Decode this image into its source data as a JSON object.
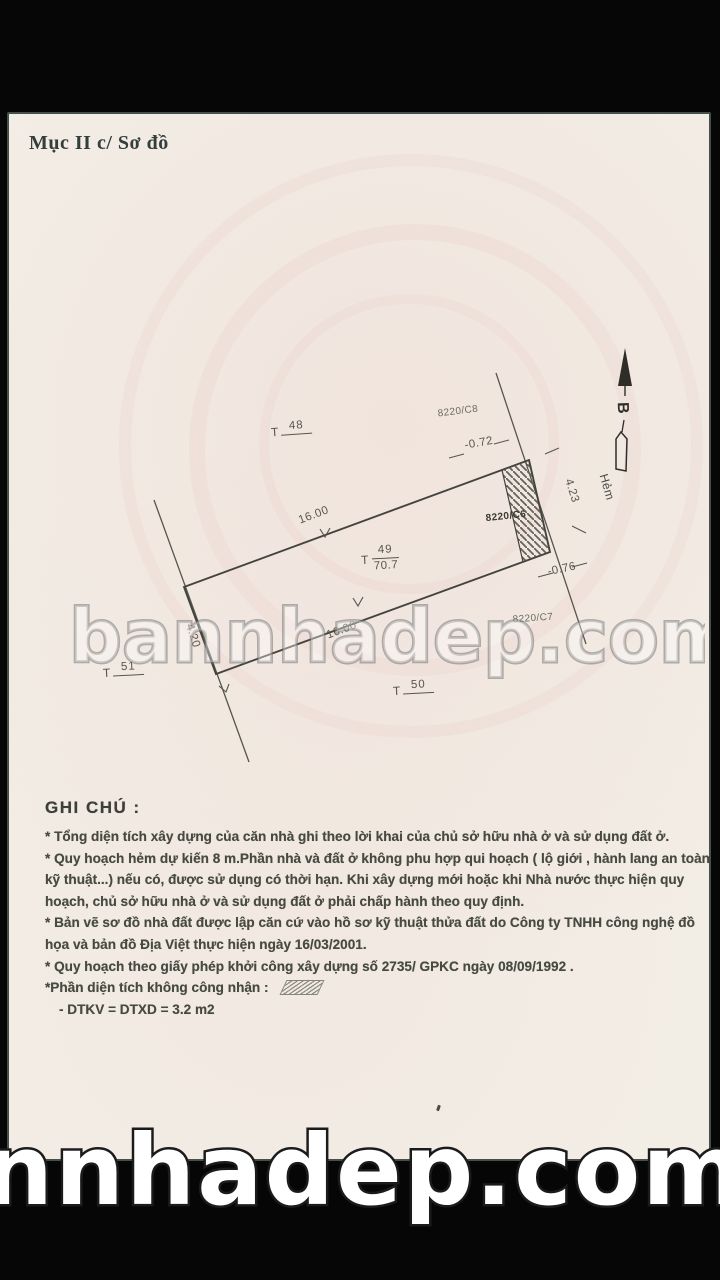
{
  "page": {
    "section_title": "Mục II c/ Sơ đồ"
  },
  "diagram": {
    "north_letter": "B",
    "alley_label": "Hẻm",
    "dim_top_edge": "16.00",
    "dim_bottom_edge": "16.00",
    "dim_left_edge": "4.20",
    "dim_right_edge": "4.23",
    "dim_offset_top": "-0.72",
    "dim_offset_bottom": "-0.76",
    "code_top": "8220/C8",
    "code_middle": "8220/C6",
    "code_bottom": "8220/C7",
    "parcel_48": {
      "prefix": "T",
      "num": "48"
    },
    "parcel_49": {
      "prefix": "T",
      "num": "49",
      "area": "70.7"
    },
    "parcel_50": {
      "prefix": "T",
      "num": "50"
    },
    "parcel_51": {
      "prefix": "T",
      "num": "51"
    }
  },
  "notes": {
    "heading": "GHI CHÚ :",
    "para1": "* Tổng diện tích xây dựng của căn nhà ghi theo lời khai của chủ sở hữu nhà ở và sử dụng đất ở.",
    "para2": "* Quy hoạch hẻm dự kiến 8 m.Phần nhà và đất ở không phu hợp qui hoạch ( lộ giới , hành lang an toàn kỹ thuật...) nếu có, được sử dụng có thời hạn. Khi xây dựng mới hoặc khi Nhà nước thực hiện quy hoạch, chủ sở hữu nhà ở và sử dụng đất ở phải chấp hành theo quy định.",
    "para3": "* Bản vẽ sơ đồ nhà đất được lập căn cứ vào hồ sơ kỹ thuật thửa đất do Công ty TNHH công nghệ đồ họa và bản đồ Địa Việt thực hiện ngày 16/03/2001.",
    "para4": "* Quy hoạch theo giấy phép khởi công xây dựng số 2735/ GPKC ngày 08/09/1992 .",
    "para5_label": "*Phần diện tích không công nhận :",
    "para6": "- DTKV = DTXD = 3.2 m2"
  },
  "watermarks": {
    "center": "bannhadep.com",
    "bottom": "nnhadep.com"
  },
  "colors": {
    "page_bg": "#f2eee6",
    "ink": "#474a40",
    "line": "#4b4b46",
    "scan_tint": "#ecbcb8"
  }
}
